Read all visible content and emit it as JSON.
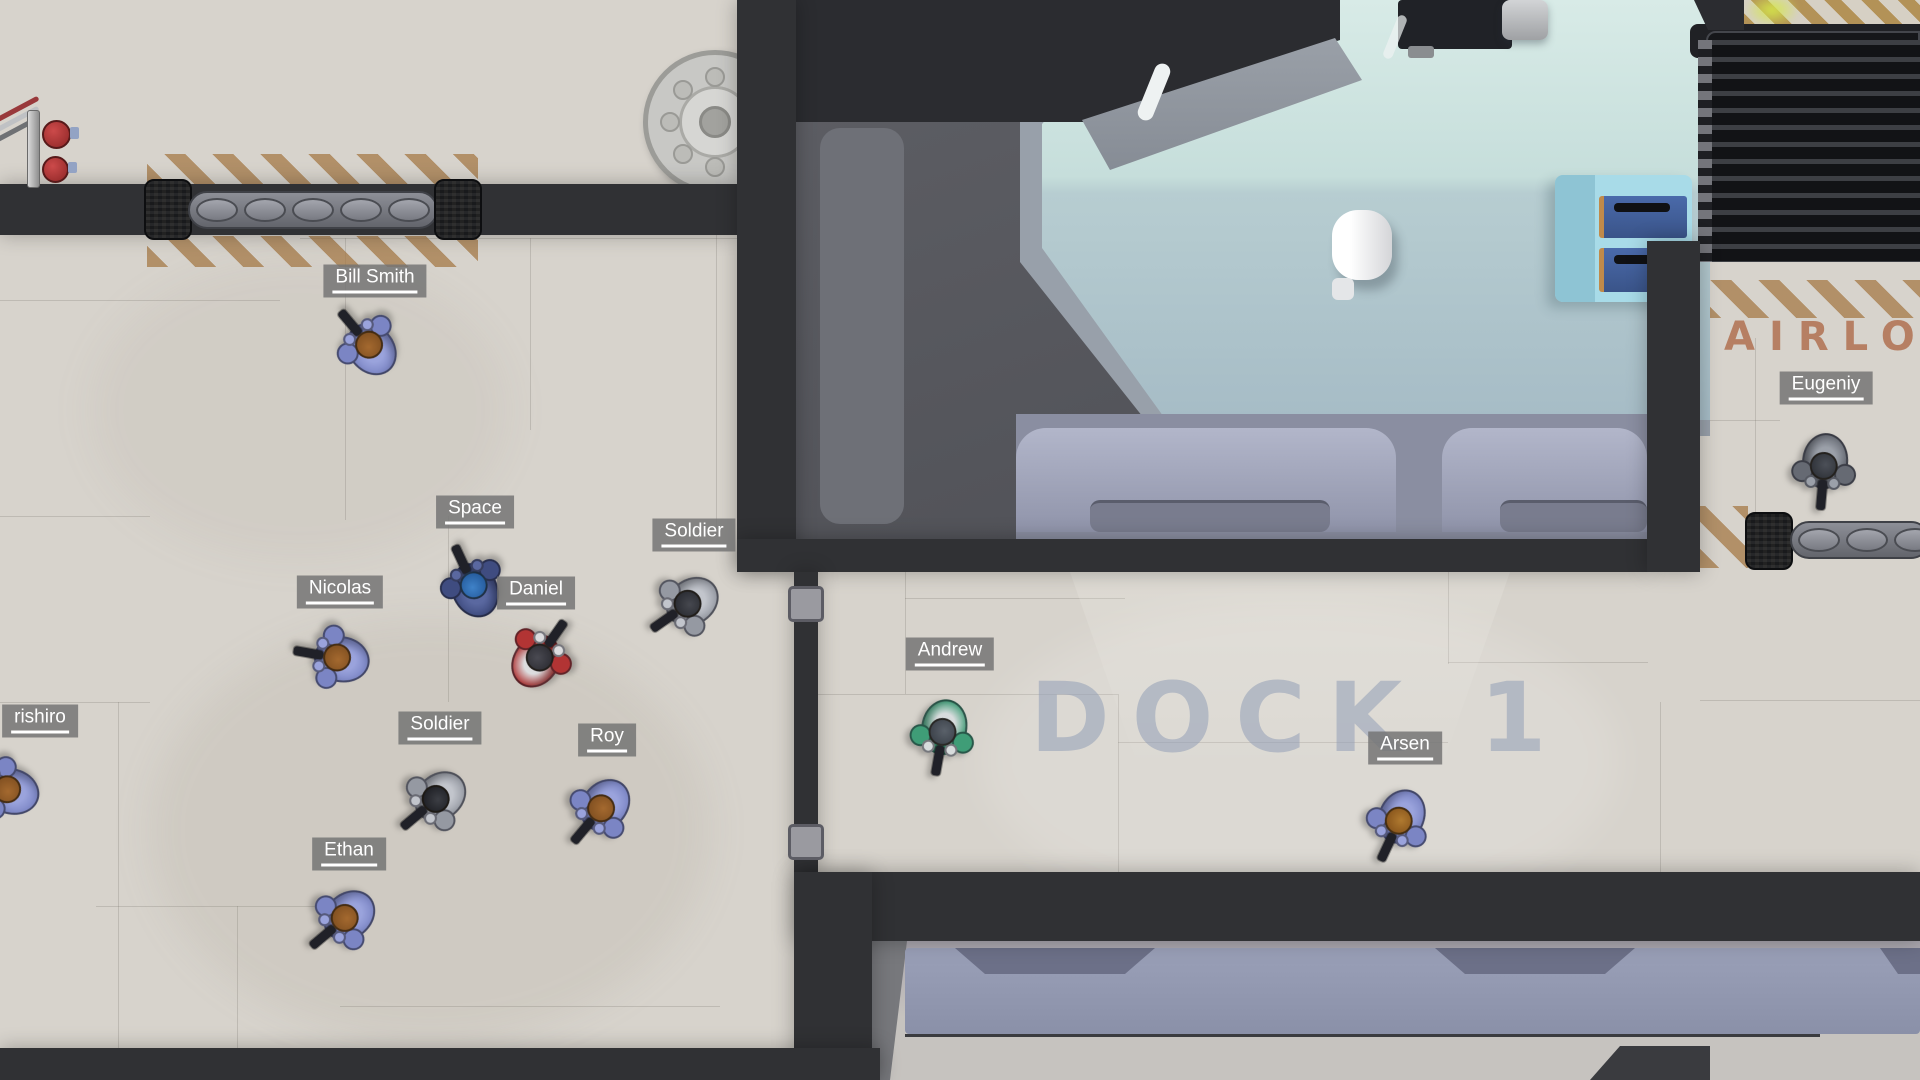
{
  "scene": {
    "floor_texts": {
      "dock": {
        "text": "DOCK 1",
        "color": "#94a2b9"
      },
      "airlock": {
        "text": "AIRLOC",
        "color": "#b2765a"
      }
    }
  },
  "players": [
    {
      "label": "Bill Smith",
      "x": 371,
      "y": 347,
      "rot": -130,
      "suit": "#7b85c4",
      "suit2": "#9aa3dc",
      "head": "#77491d",
      "head2": "#a4692f",
      "label_x": 375,
      "label_y": 281
    },
    {
      "label": "rishiro",
      "x": 10,
      "y": 790,
      "rot": 195,
      "suit": "#7b85c4",
      "suit2": "#9aa3dc",
      "head": "#77491d",
      "head2": "#a4692f",
      "label_x": 40,
      "label_y": 721
    },
    {
      "label": "Nicolas",
      "x": 340,
      "y": 658,
      "rot": 190,
      "suit": "#7b85c4",
      "suit2": "#9aa3dc",
      "head": "#77491d",
      "head2": "#a4692f",
      "label_x": 340,
      "label_y": 592
    },
    {
      "label": "Space",
      "x": 475,
      "y": 588,
      "rot": -115,
      "suit": "#3f4c80",
      "suit2": "#5a68a0",
      "head": "#1d4f8f",
      "head2": "#3f82c8",
      "label_x": 475,
      "label_y": 512
    },
    {
      "label": "Daniel",
      "x": 538,
      "y": 660,
      "rot": -55,
      "suit": "#b23434",
      "suit2": "#dcdcde",
      "head": "#26262c",
      "head2": "#4a4a52",
      "label_x": 536,
      "label_y": 593
    },
    {
      "label": "Soldier",
      "x": 690,
      "y": 602,
      "rot": 145,
      "suit": "#9599a2",
      "suit2": "#c2c5cc",
      "head": "#22242a",
      "head2": "#46484f",
      "label_x": 694,
      "label_y": 535
    },
    {
      "label": "Soldier",
      "x": 438,
      "y": 797,
      "rot": 140,
      "suit": "#9599a2",
      "suit2": "#c2c5cc",
      "head": "#16171c",
      "head2": "#3c3e44",
      "label_x": 440,
      "label_y": 728
    },
    {
      "label": "Roy",
      "x": 603,
      "y": 806,
      "rot": 130,
      "suit": "#7b85c4",
      "suit2": "#9aa3dc",
      "head": "#77491d",
      "head2": "#a4692f",
      "label_x": 607,
      "label_y": 740
    },
    {
      "label": "Ethan",
      "x": 347,
      "y": 916,
      "rot": 140,
      "suit": "#7b85c4",
      "suit2": "#9aa3dc",
      "head": "#77491d",
      "head2": "#a4692f",
      "label_x": 349,
      "label_y": 854
    },
    {
      "label": "Andrew",
      "x": 943,
      "y": 729,
      "rot": 100,
      "suit": "#3f9d77",
      "suit2": "#d8dcdd",
      "head": "#343a42",
      "head2": "#5a616a",
      "label_x": 950,
      "label_y": 654
    },
    {
      "label": "Arsen",
      "x": 1400,
      "y": 818,
      "rot": 115,
      "suit": "#7b85c4",
      "suit2": "#9aa3dc",
      "head": "#7c4a16",
      "head2": "#b07a30",
      "label_x": 1405,
      "label_y": 748
    },
    {
      "label": "Eugeniy",
      "x": 1824,
      "y": 463,
      "rot": 95,
      "suit": "#666a73",
      "suit2": "#9ba0a9",
      "head": "#282b31",
      "head2": "#4c5058",
      "label_x": 1826,
      "label_y": 388
    }
  ],
  "colors": {
    "floor": "#d7d3cc",
    "wall": "#303134",
    "teal_glass": "#c6dedb",
    "lavender_panel": "#9ba0b8",
    "hazard_stripe": "#a37642",
    "dock_text": "#94a2b9",
    "airlock_text": "#b2765a",
    "warning_light": "#a83434",
    "label_bg": "#747474",
    "label_text": "#ffffff"
  }
}
